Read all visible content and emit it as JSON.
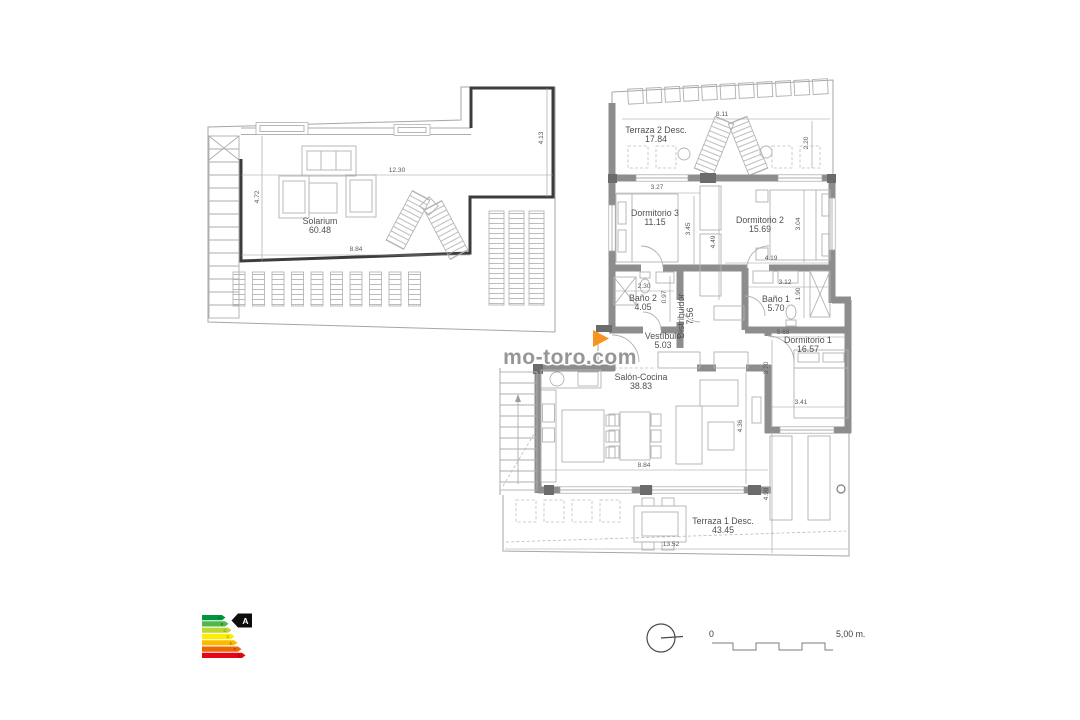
{
  "watermark": "mo-toro.com",
  "floorplan": {
    "room_labels": [
      {
        "name": "Solarium",
        "area": "60.48",
        "x": 320,
        "y": 224
      },
      {
        "name": "Terraza 2 Desc.",
        "area": "17.84",
        "x": 656,
        "y": 133
      },
      {
        "name": "Dormitorio 3",
        "area": "11.15",
        "x": 655,
        "y": 216
      },
      {
        "name": "Dormitorio 2",
        "area": "15.69",
        "x": 760,
        "y": 223
      },
      {
        "name": "Baño 2",
        "area": "4.05",
        "x": 643,
        "y": 301
      },
      {
        "name": "Baño 1",
        "area": "5.70",
        "x": 776,
        "y": 302
      },
      {
        "name": "Distribuidor",
        "area": "7.56",
        "x": 684,
        "y": 316,
        "rot": -90
      },
      {
        "name": "Vestíbulo",
        "area": "5.03",
        "x": 663,
        "y": 339
      },
      {
        "name": "Dormitorio 1",
        "area": "16.57",
        "x": 808,
        "y": 343
      },
      {
        "name": "Salón-Cocina",
        "area": "38.83",
        "x": 641,
        "y": 380
      },
      {
        "name": "Terraza 1 Desc.",
        "area": "43.45",
        "x": 723,
        "y": 524
      }
    ],
    "dimensions": [
      {
        "text": "12.30",
        "x": 397,
        "y": 172
      },
      {
        "text": "8.84",
        "x": 356,
        "y": 251
      },
      {
        "text": "4.72",
        "x": 259,
        "y": 197,
        "rot": -90
      },
      {
        "text": "4.13",
        "x": 543,
        "y": 138,
        "rot": -90
      },
      {
        "text": "8.11",
        "x": 722,
        "y": 116
      },
      {
        "text": "2.20",
        "x": 808,
        "y": 143,
        "rot": -90
      },
      {
        "text": "3.27",
        "x": 657,
        "y": 189
      },
      {
        "text": "3.45",
        "x": 690,
        "y": 229,
        "rot": -90
      },
      {
        "text": "4.49",
        "x": 715,
        "y": 242,
        "rot": -90
      },
      {
        "text": "3.04",
        "x": 800,
        "y": 224,
        "rot": -90
      },
      {
        "text": "4.19",
        "x": 771,
        "y": 260
      },
      {
        "text": "2.30",
        "x": 644,
        "y": 288
      },
      {
        "text": "0.97",
        "x": 666,
        "y": 297,
        "rot": -90
      },
      {
        "text": "3.12",
        "x": 785,
        "y": 284
      },
      {
        "text": "1.90",
        "x": 800,
        "y": 294,
        "rot": -90
      },
      {
        "text": "5.68",
        "x": 783,
        "y": 334
      },
      {
        "text": "3.70",
        "x": 768,
        "y": 368,
        "rot": -90
      },
      {
        "text": "3.41",
        "x": 801,
        "y": 404
      },
      {
        "text": "4.36",
        "x": 742,
        "y": 426,
        "rot": -90
      },
      {
        "text": "8.84",
        "x": 644,
        "y": 467
      },
      {
        "text": "4.98",
        "x": 768,
        "y": 494,
        "rot": -90
      },
      {
        "text": "13.52",
        "x": 671,
        "y": 546
      }
    ]
  },
  "energy_label": {
    "rating": "A",
    "bars": [
      {
        "letter": "A",
        "color": "#009641",
        "width": 20
      },
      {
        "letter": "B",
        "color": "#50b848",
        "width": 23
      },
      {
        "letter": "C",
        "color": "#bdd630",
        "width": 26
      },
      {
        "letter": "D",
        "color": "#ffed00",
        "width": 29
      },
      {
        "letter": "E",
        "color": "#fbba00",
        "width": 32
      },
      {
        "letter": "F",
        "color": "#ec6608",
        "width": 36
      },
      {
        "letter": "G",
        "color": "#e30613",
        "width": 40
      }
    ]
  },
  "scale_bar": {
    "zero": "0",
    "max": "5,00 m."
  },
  "accent_arrow_color": "#f7941e"
}
